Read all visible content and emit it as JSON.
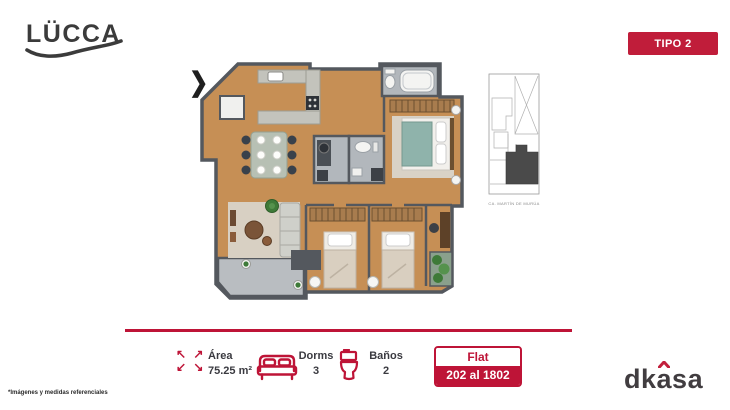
{
  "header": {
    "logo_text": "LÜCCA",
    "type_badge": "TIPO 2"
  },
  "plan": {
    "entry_arrow_glyph": "❯",
    "map_caption": "CA. MARTÍN DE MURÚA",
    "rooms_depicted": "kitchen, dining, living, balcony, 3 bedrooms, 2 bathrooms, desk nook"
  },
  "info_bar": {
    "area": {
      "label": "Área",
      "value": "75.25 m²"
    },
    "dorms": {
      "label": "Dorms",
      "value": "3"
    },
    "banos": {
      "label": "Baños",
      "value": "2"
    },
    "flat": {
      "label": "Flat",
      "range": "202 al 1802"
    },
    "icons": {
      "expand_row_top": "↖ ↗",
      "expand_row_bottom": "↙ ↘",
      "bed": "double-bed-icon",
      "toilet": "toilet-icon"
    }
  },
  "footer": {
    "brand_pre": "dk",
    "brand_accent_letter": "a",
    "brand_post": "sa",
    "footnote": "*Imágenes y medidas referenciales"
  },
  "colors": {
    "accent_red": "#be1437",
    "badge_red": "#c01d3a",
    "text_dark": "#3a3a40",
    "logo_dark": "#3b3b3b",
    "wood_floor": "#c68f55",
    "wall_gray": "#54585e",
    "bath_gray": "#b2b7bc"
  }
}
